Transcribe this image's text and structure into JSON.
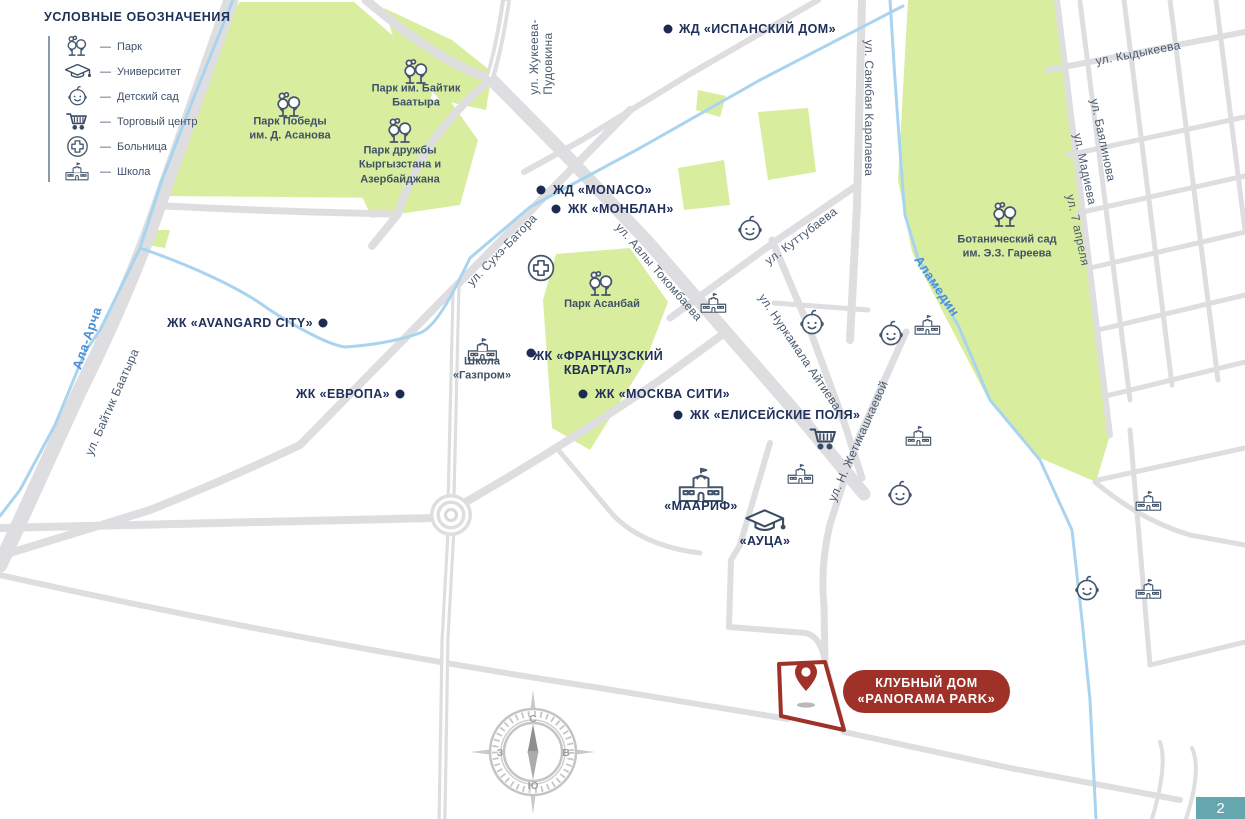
{
  "legend": {
    "title": "УСЛОВНЫЕ ОБОЗНАЧЕНИЯ",
    "dash": "—",
    "items": [
      {
        "icon": "park-icon",
        "label": "Парк"
      },
      {
        "icon": "university-icon",
        "label": "Университет"
      },
      {
        "icon": "kindergarten-icon",
        "label": "Детский сад"
      },
      {
        "icon": "shopping-cart-icon",
        "label": "Торговый центр"
      },
      {
        "icon": "hospital-icon",
        "label": "Больница"
      },
      {
        "icon": "school-icon",
        "label": "Школа"
      }
    ]
  },
  "pois": {
    "ispansky": "ЖД «ИСПАНСКИЙ ДОМ»",
    "monaco": "ЖД «MONACO»",
    "monblan": "ЖК «МОНБЛАН»",
    "avangard": "ЖК «AVANGARD CITY»",
    "evropa": "ЖК «ЕВРОПА»",
    "french": "ЖК «ФРАНЦУЗСКИЙ\nКВАРТАЛ»",
    "moskva": "ЖК «МОСКВА СИТИ»",
    "elisey": "ЖК «ЕЛИСЕЙСКИЕ ПОЛЯ»",
    "maarif": "«МААРИФ»",
    "auca": "«АУЦА»",
    "gazprom": "Школа\n«Газпром»"
  },
  "parks": {
    "pobedy": "Парк Победы\nим. Д. Асанова",
    "baytik": "Парк им. Байтик\nБаатыра",
    "druzhby": "Парк дружбы\nКыргызстана и\nАзербайджана",
    "asanbay": "Парк Асанбай",
    "botanical": "Ботанический сад\nим. Э.З. Гареева"
  },
  "streets": {
    "zhukeeva": "ул. Жукеева-\nПудовкина",
    "sayakbaya": "ул. Саякбая Каралаева",
    "kydykeeva": "ул. Кыдыкеева",
    "bayalinova": "ул. Баялинова",
    "madieva": "ул. Мадиева",
    "aprelya": "ул. 7 апреля",
    "suhe": "ул. Сухэ-Батора",
    "tokombaeva": "ул. Аалы Токомбаева",
    "kuttubaeva": "ул. Куттубаева",
    "aytieva": "ул. Нуркамала Айтиева",
    "zhetikashkaeva": "ул. Н. Жетикашкаевой",
    "baytik": "ул. Байтик Баатыра"
  },
  "rivers": {
    "alaarcha": "Ала-Арча",
    "alamedin": "Аламедин"
  },
  "badge": {
    "line1": "КЛУБНЫЙ ДОМ",
    "line2": "«PANORAMA PARK»"
  },
  "compass": {
    "north": "С",
    "south": "Ю",
    "west": "З",
    "east": "В"
  },
  "page_number": "2",
  "colors": {
    "park_green": "#d9ed9f",
    "road_gray": "#dedee0",
    "river_blue_line": "#a9d4ef",
    "river_label_blue": "#4a90d5",
    "poi_navy": "#20305a",
    "street_slate": "#4a5b70",
    "icon_slate": "#44566b",
    "accent_red": "#9f3129",
    "page_teal": "#66a7af"
  }
}
